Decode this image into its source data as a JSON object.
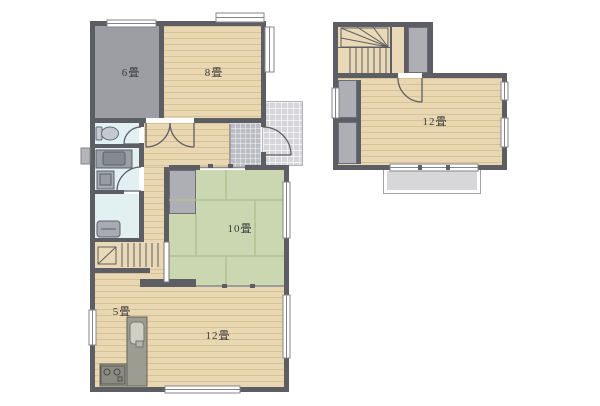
{
  "plan_type": "house-floor-plan",
  "floor1": {
    "rooms": {
      "r6": {
        "label": "6畳"
      },
      "r8": {
        "label": "8畳"
      },
      "r10": {
        "label": "10畳"
      },
      "kitchen": {
        "label": "5畳"
      },
      "ldk": {
        "label": "12畳"
      }
    }
  },
  "floor2": {
    "rooms": {
      "r12": {
        "label": "12畳"
      }
    }
  },
  "colors": {
    "wall": "#5d5d64",
    "wood_floor": "#e9d7b1",
    "tatami": "#cbd7b1",
    "gray_room": "#9d9da4",
    "wet_room": "#e2f0f2",
    "porch_tile": "#d6d6da",
    "genkan_tile": "#bcbcc3",
    "closet": "#aeaeb5",
    "balcony": "#d7d7da"
  }
}
